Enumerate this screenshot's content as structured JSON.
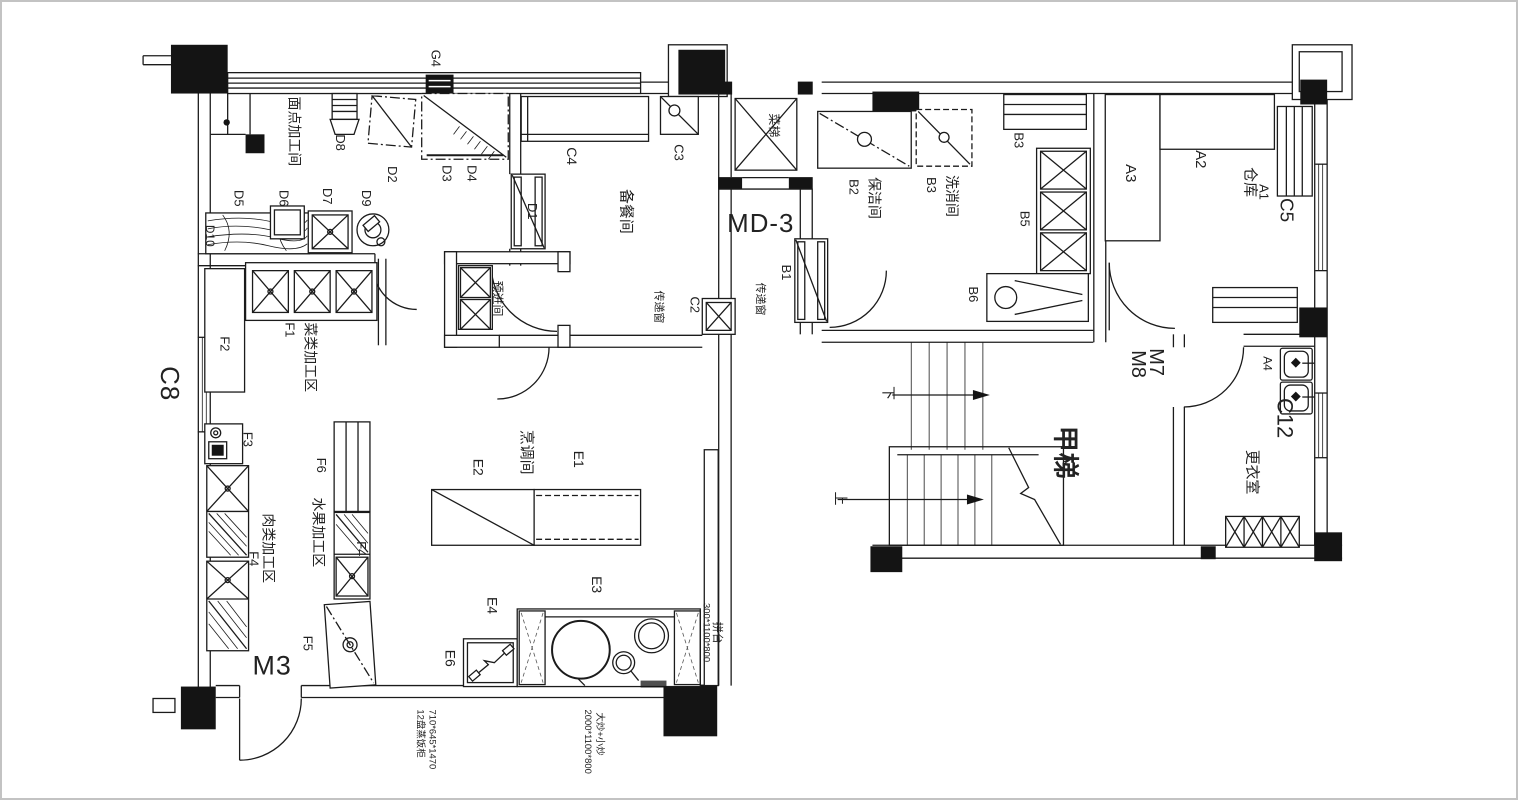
{
  "plan": {
    "colors": {
      "line": "#1b1b1b",
      "paper": "#ffffff",
      "frame": "#c3c3c3"
    },
    "rooms": {
      "pastry": "面点加工间",
      "prep": "备餐间",
      "pre_entry": "预进间",
      "veg": "菜类加工区",
      "fruit": "水果加工区",
      "meat": "肉类加工区",
      "cooking": "烹调间",
      "cleaning": "保洁间",
      "sterilize": "洗消间",
      "warehouse": "仓库",
      "locker": "更衣室"
    },
    "circulation": {
      "stair_name": "甲梯",
      "up": "上",
      "down": "下",
      "food_lift": "菜梯",
      "fire_door": "MD-3"
    },
    "openings": {
      "g4": "G4",
      "c8": "C8",
      "c5": "C5",
      "c12": "C12",
      "c4": "C4",
      "c3": "C3",
      "c2": "C2",
      "b1": "B1",
      "d1": "D1",
      "m3": "M3",
      "m7": "M7",
      "m8": "M8",
      "pass_a": "传递窗",
      "pass_b": "传递窗"
    },
    "equipment": {
      "d2": "D2",
      "d3": "D3",
      "d4": "D4",
      "d5": "D5",
      "d6": "D6",
      "d7": "D7",
      "d8": "D8",
      "d9": "D9",
      "d10": "D10",
      "b2": "B2",
      "b3": "B3",
      "b3_rack": "B3",
      "b5": "B5",
      "b6": "B6",
      "a1": "A1",
      "a2": "A2",
      "a3": "A3",
      "a4": "A4",
      "f1": "F1",
      "f2": "F2",
      "f3": "F3",
      "f4_left": "F4",
      "f4_right": "F4",
      "f5": "F5",
      "f6": "F6",
      "e1": "E1",
      "e2": "E2",
      "e3": "E3",
      "e4": "E4",
      "e6": "E6"
    },
    "annotations": {
      "steamer_name": "12盘蒸饭柜",
      "steamer_size": "710*645*1470",
      "wok_size": "2000*1100*800",
      "wok_name": "大炒+小炒",
      "side_table_size": "300*1100*800",
      "side_table": "拼台"
    }
  }
}
